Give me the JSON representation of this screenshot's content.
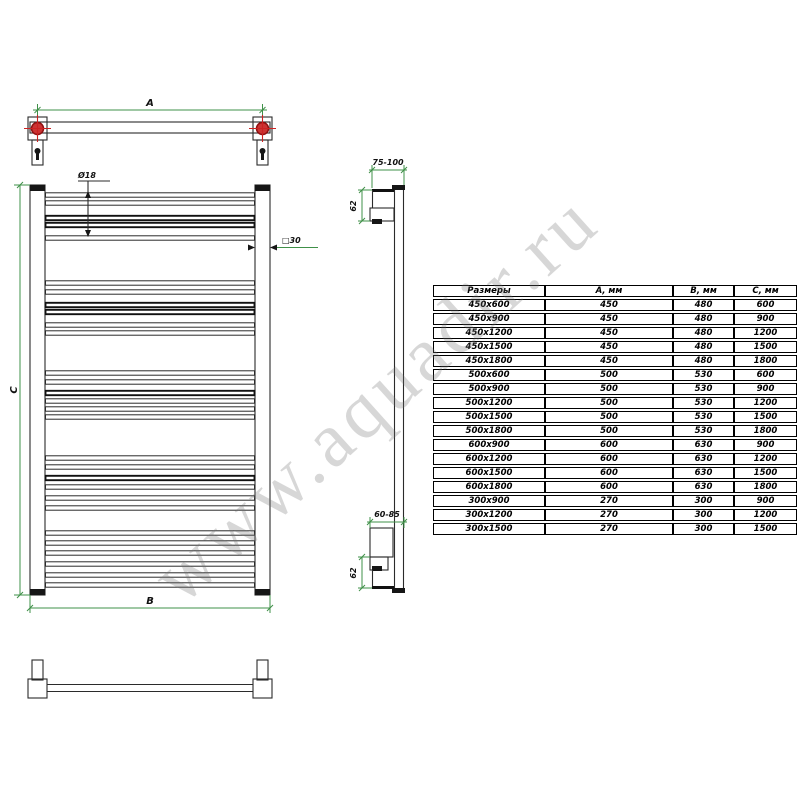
{
  "watermark": {
    "text": "www.aquadir.ru"
  },
  "drawing": {
    "labels": {
      "dim_a": "A",
      "dim_b": "B",
      "dim_c": "C",
      "rung_diameter": "Ø18",
      "post_profile": "□30",
      "top_wall_offset": "75-100",
      "bottom_wall_offset": "60-85",
      "top_bracket_height": "62",
      "bottom_bracket_height": "62"
    },
    "colors": {
      "line": "#2b2b2b",
      "dimension_green": "#3f9048",
      "bracket_red": "#cc2222",
      "watermark_gray": "#787878"
    },
    "front_view_rungs": [
      {
        "y": 195,
        "bold": false
      },
      {
        "y": 203,
        "bold": false
      },
      {
        "y": 218,
        "bold": true
      },
      {
        "y": 225,
        "bold": true
      },
      {
        "y": 238,
        "bold": false
      },
      {
        "y": 283,
        "bold": false
      },
      {
        "y": 292,
        "bold": false
      },
      {
        "y": 305,
        "bold": true
      },
      {
        "y": 312,
        "bold": true
      },
      {
        "y": 325,
        "bold": false
      },
      {
        "y": 333,
        "bold": false
      },
      {
        "y": 373,
        "bold": false
      },
      {
        "y": 382,
        "bold": false
      },
      {
        "y": 393,
        "bold": true
      },
      {
        "y": 401,
        "bold": false
      },
      {
        "y": 409,
        "bold": false
      },
      {
        "y": 417,
        "bold": false
      },
      {
        "y": 458,
        "bold": false
      },
      {
        "y": 467,
        "bold": false
      },
      {
        "y": 478,
        "bold": true
      },
      {
        "y": 487,
        "bold": false
      },
      {
        "y": 498,
        "bold": false
      },
      {
        "y": 508,
        "bold": false
      },
      {
        "y": 533,
        "bold": false
      },
      {
        "y": 543,
        "bold": false
      },
      {
        "y": 553,
        "bold": false
      },
      {
        "y": 564,
        "bold": false
      },
      {
        "y": 575,
        "bold": false
      },
      {
        "y": 585,
        "bold": false
      }
    ]
  },
  "table": {
    "headers": [
      "Размеры",
      "А, мм",
      "В, мм",
      "С, мм"
    ],
    "rows": [
      [
        "450х600",
        "450",
        "480",
        "600"
      ],
      [
        "450х900",
        "450",
        "480",
        "900"
      ],
      [
        "450х1200",
        "450",
        "480",
        "1200"
      ],
      [
        "450х1500",
        "450",
        "480",
        "1500"
      ],
      [
        "450х1800",
        "450",
        "480",
        "1800"
      ],
      [
        "500х600",
        "500",
        "530",
        "600"
      ],
      [
        "500х900",
        "500",
        "530",
        "900"
      ],
      [
        "500х1200",
        "500",
        "530",
        "1200"
      ],
      [
        "500х1500",
        "500",
        "530",
        "1500"
      ],
      [
        "500х1800",
        "500",
        "530",
        "1800"
      ],
      [
        "600х900",
        "600",
        "630",
        "900"
      ],
      [
        "600х1200",
        "600",
        "630",
        "1200"
      ],
      [
        "600х1500",
        "600",
        "630",
        "1500"
      ],
      [
        "600х1800",
        "600",
        "630",
        "1800"
      ],
      [
        "300х900",
        "270",
        "300",
        "900"
      ],
      [
        "300х1200",
        "270",
        "300",
        "1200"
      ],
      [
        "300х1500",
        "270",
        "300",
        "1500"
      ]
    ]
  }
}
